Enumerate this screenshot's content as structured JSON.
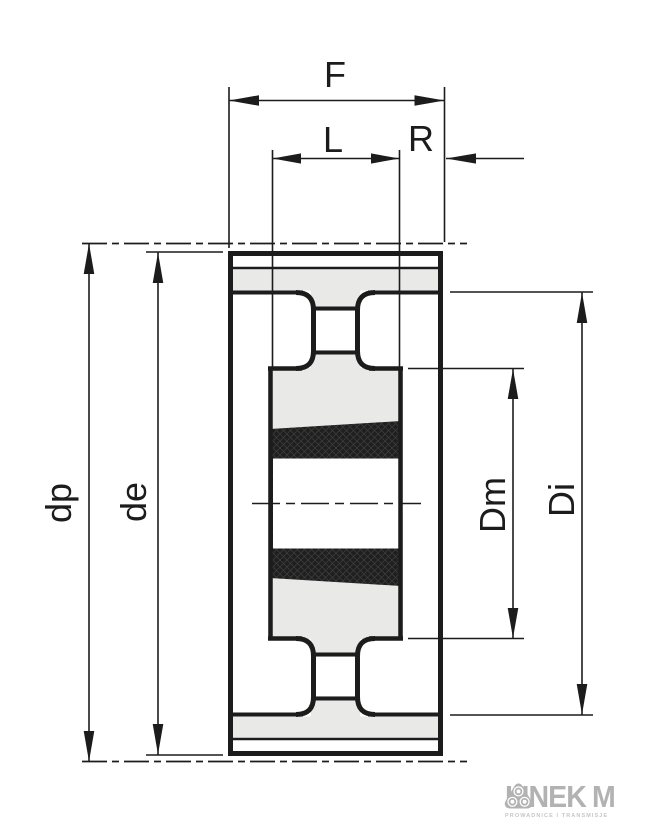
{
  "drawing": {
    "title": "taper-bush timing pulley cross-section",
    "dimensions": {
      "overall_width": "F",
      "bushing_length": "L",
      "hub_protrusion": "R",
      "pitch_diameter": "dp",
      "outside_diameter": "de",
      "hub_diameter": "Dm",
      "inner_diameter": "Di"
    },
    "colors": {
      "line": "#1c1c1c",
      "section_fill": "#e9e9e7",
      "bushing_fill": "#1f1f1f",
      "background": "#ffffff"
    }
  },
  "logo": {
    "brand_prefix": "LINEK",
    "brand_suffix": "M",
    "emblem": "three-rollers-icon",
    "tagline": "PROWADNICE I TRANSMISJE",
    "color": "#b2b2b2"
  }
}
